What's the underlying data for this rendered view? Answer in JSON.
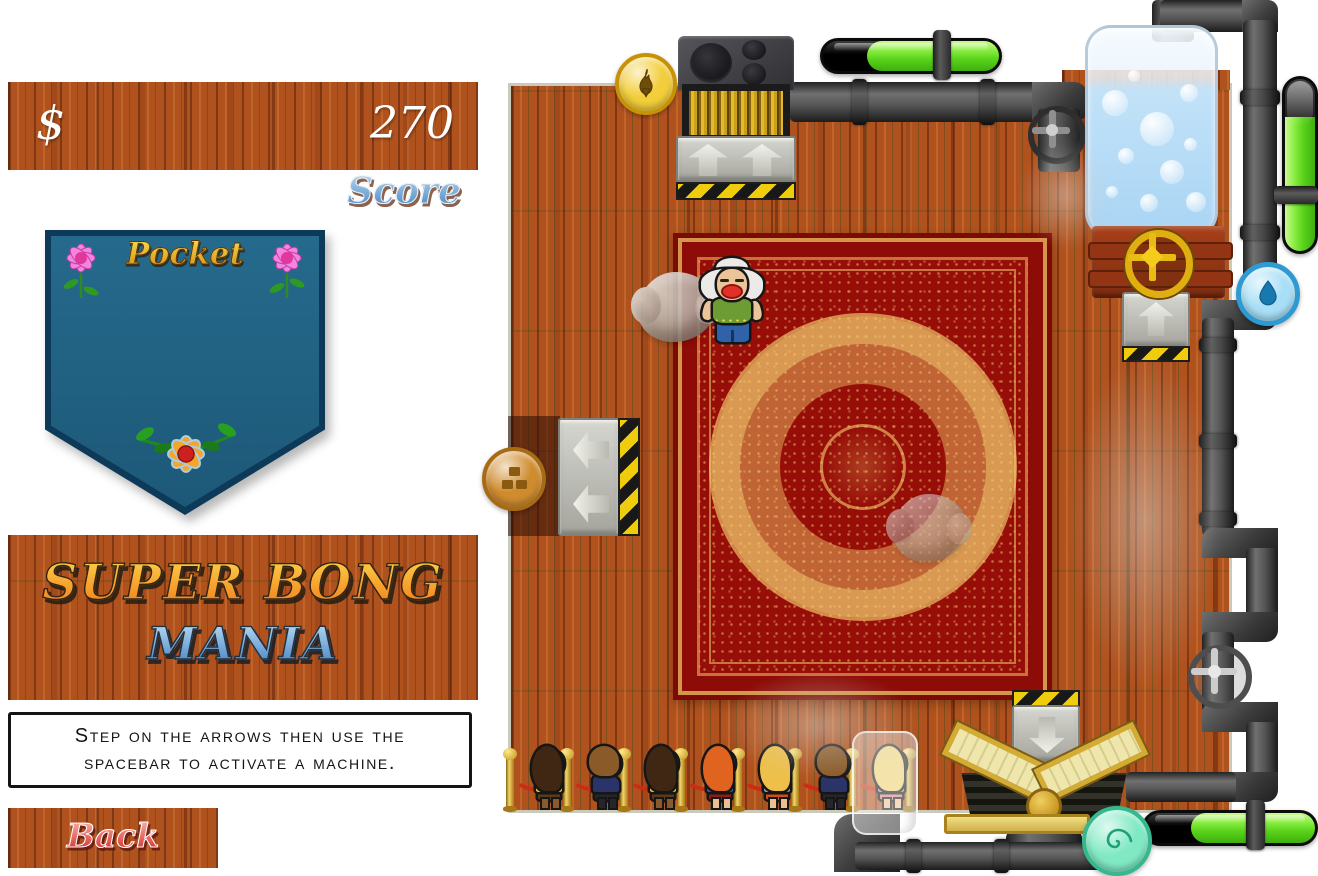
{
  "hud": {
    "currency_symbol": "$",
    "score_value": "270",
    "score_label": "Score"
  },
  "pocket": {
    "label": "Pocket"
  },
  "title": {
    "line1": "SUPER BONG",
    "line2": "MANIA"
  },
  "instructions": {
    "line1": "Step on the arrows then use the",
    "line2": "spacebar to activate a machine."
  },
  "back_button": {
    "label": "Back"
  },
  "game": {
    "gauges": [
      {
        "id": "furnace-gauge",
        "orientation": "horizontal",
        "fill_percent": 75
      },
      {
        "id": "tank-gauge",
        "orientation": "vertical",
        "fill_percent": 78
      },
      {
        "id": "press-gauge",
        "orientation": "horizontal",
        "fill_percent": 73
      }
    ],
    "badges": [
      {
        "id": "flame-coin",
        "icon": "flame-icon",
        "color": "#f2ce3a"
      },
      {
        "id": "bricks-coin",
        "icon": "bricks-icon",
        "color": "#cf8c2e"
      },
      {
        "id": "water-badge",
        "icon": "water-drop-icon",
        "color": "#a8dff6"
      },
      {
        "id": "swirl-badge",
        "icon": "spiral-icon",
        "color": "#80e9c4"
      }
    ],
    "granny": {
      "hair": "#eceae6",
      "skin": "#ecc49a",
      "top": "#6e9c34",
      "pants": "#2f62a8",
      "lips": "#e03028"
    },
    "queue": {
      "people": [
        {
          "gender": "f",
          "long_hair": true,
          "skin": "#8a5a2a",
          "hair": "#3f2714",
          "top": "#eec61c",
          "bottom": "#5a3a1a",
          "legs": "#8a5a2a",
          "highlighted": false
        },
        {
          "gender": "m",
          "long_hair": false,
          "skin": "#ecbf92",
          "hair": "#8a5a28",
          "top": "#2b3468",
          "bottom": "#26262a",
          "legs": "#26262a",
          "highlighted": false
        },
        {
          "gender": "f",
          "long_hair": true,
          "skin": "#8a5a2a",
          "hair": "#3f2714",
          "top": "#eec61c",
          "bottom": "#5a3a1a",
          "legs": "#8a5a2a",
          "highlighted": false
        },
        {
          "gender": "f",
          "long_hair": true,
          "skin": "#ecbf92",
          "hair": "#e06420",
          "top": "#3a5cae",
          "bottom": "#8e1a1a",
          "legs": "#ecbf92",
          "highlighted": false
        },
        {
          "gender": "f",
          "long_hair": true,
          "skin": "#ecbf92",
          "hair": "#eec04a",
          "top": "#9b9ba3",
          "bottom": "#cc4f1e",
          "legs": "#ecbf92",
          "highlighted": false
        },
        {
          "gender": "m",
          "long_hair": false,
          "skin": "#ecbf92",
          "hair": "#8a5a28",
          "top": "#2b3468",
          "bottom": "#26262a",
          "legs": "#26262a",
          "highlighted": false
        },
        {
          "gender": "f",
          "long_hair": true,
          "skin": "#ecbf92",
          "hair": "#ecd070",
          "top": "#a0a0a8",
          "bottom": "#d88080",
          "legs": "#ecbf92",
          "highlighted": true
        }
      ]
    },
    "colors": {
      "wood": "#b0521e",
      "carpet_red": "#970d08",
      "carpet_gold": "#e8c56a",
      "pocket_blue": "#21607f",
      "gauge_green": "#57d219",
      "pipe_gray": "#4a4a4a",
      "hazard_yellow": "#f0cd0c"
    }
  }
}
